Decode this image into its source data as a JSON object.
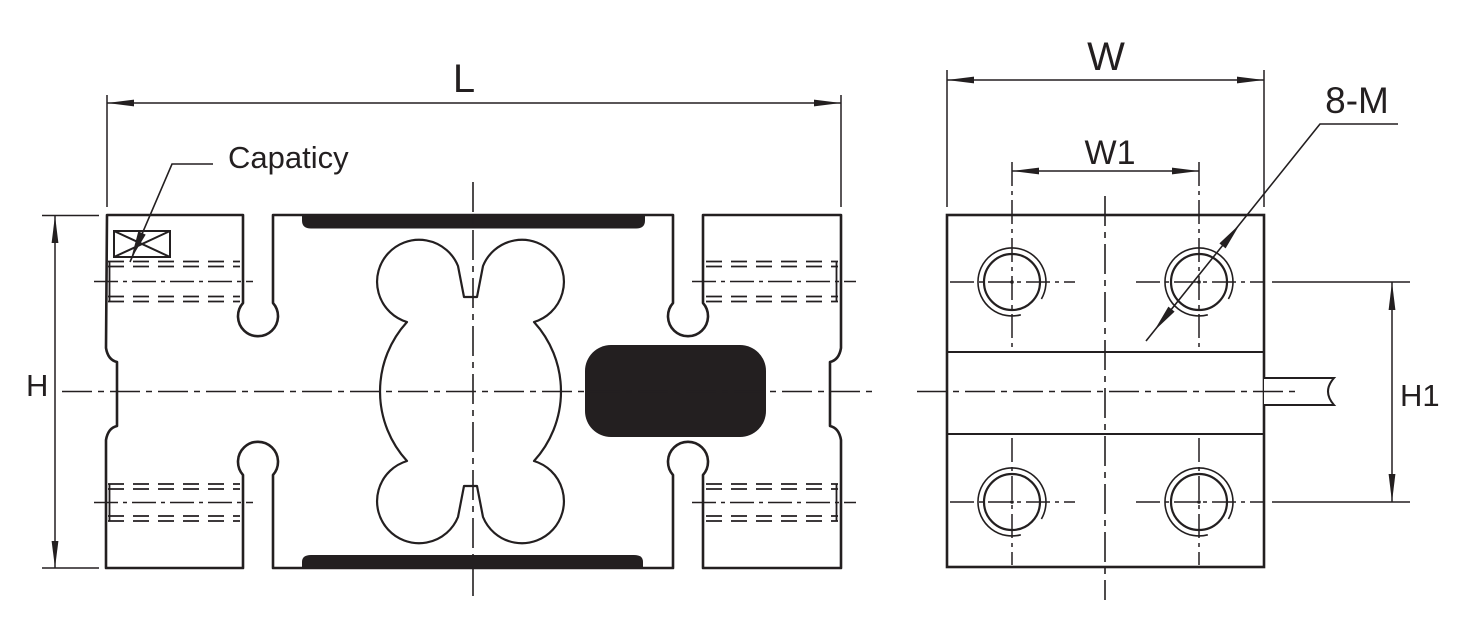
{
  "drawing": {
    "type": "load-cell-dimension-drawing",
    "labels": {
      "length": "L",
      "height": "H",
      "width": "W",
      "width1": "W1",
      "height1": "H1",
      "thread_callout": "8-M",
      "capacity": "Capaticy"
    },
    "colors": {
      "ink": "#231f20",
      "background": "#ffffff"
    }
  }
}
